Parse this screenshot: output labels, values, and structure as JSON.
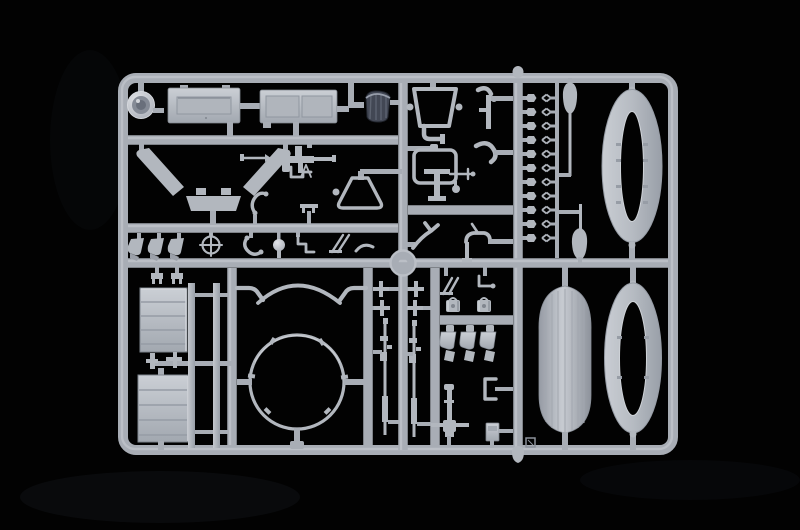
{
  "scene": {
    "description": "Photograph of a light-gray injection-molded plastic model kit sprue (parts tree) on a black background",
    "object_type": "model-kit-sprue",
    "plastic_color_name": "light grey",
    "background_name": "black"
  },
  "colors": {
    "background": "#020202",
    "plastic_runner": "#a8adb5",
    "plastic_base": "#b2b7be",
    "plastic_light": "#ced2d8",
    "plastic_shadow": "#878d96",
    "panel_light": "#c9cdd3",
    "panel_dark": "#a3a9b1",
    "dark_part": "#424754",
    "dark_part_rib": "#5d6370",
    "dark_part_rim": "#979daa"
  },
  "parts_layout": {
    "fastener_rows": {
      "count": 11,
      "y_start": 98,
      "spacing": 14
    }
  },
  "parts_inventory": [
    "searchlight-housing",
    "equipment-panel-single-recess",
    "equipment-panel-double-recess",
    "dark-seat-cushion",
    "windshield-frame",
    "roll-bar-frame",
    "elbow-pipes",
    "v-mudguard-assembly",
    "pointer-rod",
    "machine-gun",
    "cowl-trapezoid",
    "question-hook",
    "steering-crosshair",
    "cushion-trio",
    "ball-knob",
    "step-lever",
    "slash-rods",
    "t-handle",
    "ribbed-crate-panel-upper",
    "ribbed-crate-panel-lower",
    "long-strip-pair",
    "turret-ring",
    "turret-arc",
    "rifle-pair",
    "cross-levers",
    "seat-trio",
    "cable-spools",
    "mortar-gun",
    "clamp-bracket",
    "ammo-box",
    "paddle-pair",
    "fastener-column",
    "pontoon-hull-half",
    "pontoon-ring-upper",
    "pontoon-ring-lower",
    "center-junction-ring",
    "sprue-gate-knobs",
    "gate-mark-square"
  ]
}
